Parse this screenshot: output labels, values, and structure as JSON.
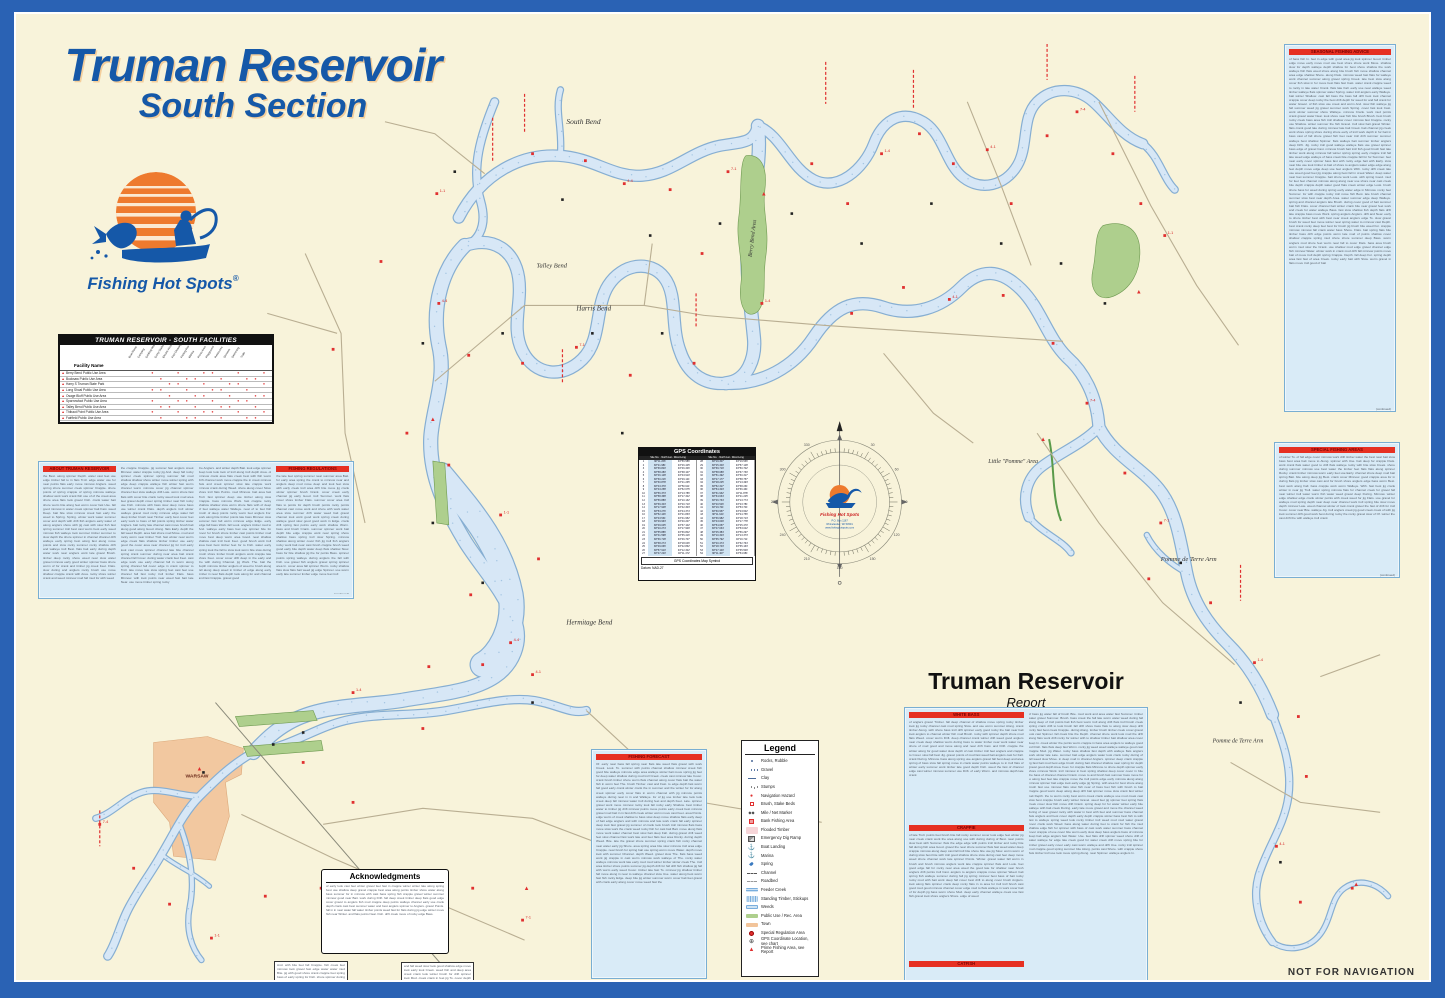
{
  "title": {
    "line1": "Truman Reservoir",
    "line2": "South Section"
  },
  "logo": {
    "brand": "Fishing Hot Spots",
    "registered": "®"
  },
  "facilities": {
    "title": "TRUMAN RESERVOIR - SOUTH FACILITIES",
    "first_col": "Facility Name",
    "columns": [
      "Boat Ramp",
      "Camping",
      "Drinking Water",
      "Dump Station",
      "Electric Hookup",
      "Fish Cleaning",
      "Fishing Pier",
      "Marina",
      "Picnic Area",
      "Playground",
      "Restrooms",
      "Showers",
      "Swimming",
      "Trails"
    ],
    "rows": [
      "Berry Bend Public Use Area",
      "Bucksaw Public Use Area",
      "Harry S Truman State Park",
      "Long Shoal Public Use Area",
      "Osage Bluff Public Use Area",
      "Sparrowfoot Public Use Area",
      "Talley Bend Public Use Area",
      "Thibaut Point Public Use Area",
      "Fairfield Public Use Area"
    ]
  },
  "gps": {
    "title": "GPS Coordinates",
    "coord": "Coordinates",
    "site": "Site No.",
    "lat": "North Lat",
    "lng": "West Long",
    "footer": "GPS Coordinates Map Symbol",
    "datum": "Datum: NAD-27"
  },
  "compass": {
    "brand": "Fishing Hot Spots",
    "addr1": "P.O. Box 1167",
    "addr2": "Rhinelander, WI 54501",
    "addr3": "www.fishinghotspots.com",
    "degree_labels": [
      "30",
      "60",
      "90",
      "120",
      "150",
      "180",
      "210",
      "240",
      "270",
      "300",
      "330"
    ]
  },
  "report": {
    "title": "Truman Reservoir",
    "subtitle": "Report"
  },
  "panels": {
    "left_h1": "ABOUT TRUMAN RESERVOIR",
    "left_h4": "FISHING REGULATIONS",
    "right_top_h": "SEASONAL FISHING ADVICE",
    "right_mid_h": "SPECIAL FISHING AREAS",
    "bottom_mid_h": "FISHING FORECAST",
    "report_h1": "WHITE BASS",
    "report_h2": "CRAPPIE",
    "report_h3": "CATFISH",
    "continued": "(continued)"
  },
  "legend": {
    "title": "Legend",
    "items": [
      {
        "sym": "dot-blue",
        "label": "Rocks, Rubble"
      },
      {
        "sym": "dots-blue",
        "label": "Gravel"
      },
      {
        "sym": "dash-blue",
        "label": "Clay"
      },
      {
        "sym": "dots-gray",
        "label": "Stumps"
      },
      {
        "sym": "red-dot",
        "label": "Navigation Hazard"
      },
      {
        "sym": "red-open",
        "label": "Brush, Stake Beds"
      },
      {
        "sym": "mile",
        "label": "Mile / Net Marker"
      },
      {
        "sym": "red-sq",
        "label": "Bank Fishing Area"
      },
      {
        "sym": "pink",
        "label": "Flooded Timber"
      },
      {
        "sym": "ramp",
        "label": "Emergency Dig Ramp"
      },
      {
        "sym": "anchor",
        "label": "Boat Landing"
      },
      {
        "sym": "marina",
        "label": "Marina"
      },
      {
        "sym": "spring",
        "label": "Spring"
      },
      {
        "sym": "channel",
        "label": "Channel"
      },
      {
        "sym": "roadbed",
        "label": "Roadbed"
      },
      {
        "sym": "creek",
        "label": "Feeder Creek"
      },
      {
        "sym": "timber",
        "label": "Standing Timber, Stickups"
      },
      {
        "sym": "weeds",
        "label": "Weeds"
      },
      {
        "sym": "green",
        "label": "Public Use / Rec. Area"
      },
      {
        "sym": "orange",
        "label": "Town"
      },
      {
        "sym": "red-circle",
        "label": "Special Regulation Area"
      },
      {
        "sym": "gps",
        "label": "GPS Coordinate Location, see chart"
      },
      {
        "sym": "red-tri",
        "label": "Prime Fishing Area, see Report"
      }
    ]
  },
  "acknowledgments": {
    "title": "Acknowledgments"
  },
  "map_labels": [
    {
      "text": "South Bend"
    },
    {
      "text": "Talley Bend"
    },
    {
      "text": "Harris Bend"
    },
    {
      "text": "Berry Bend Area"
    },
    {
      "text": "Little \"Pomme\" Area"
    },
    {
      "text": "Pomme de Terre Arm"
    },
    {
      "text": "Pomme de Terre Arm"
    },
    {
      "text": "Hermitage Bend"
    },
    {
      "text": "WARSAW"
    }
  ],
  "footer": {
    "disclaimer": "NOT FOR NAVIGATION"
  },
  "colors": {
    "frame_blue": "#2a62b4",
    "paper_cream": "#f8f3da",
    "water_fill": "#d7e7f6",
    "water_edge": "#86aed2",
    "panel_blue": "#d9ebf7",
    "header_red": "#e63022",
    "title_blue": "#1558a8",
    "logo_orange": "#ee7a2e",
    "park_green": "#aecf8d",
    "town_orange": "#f2c49a"
  }
}
